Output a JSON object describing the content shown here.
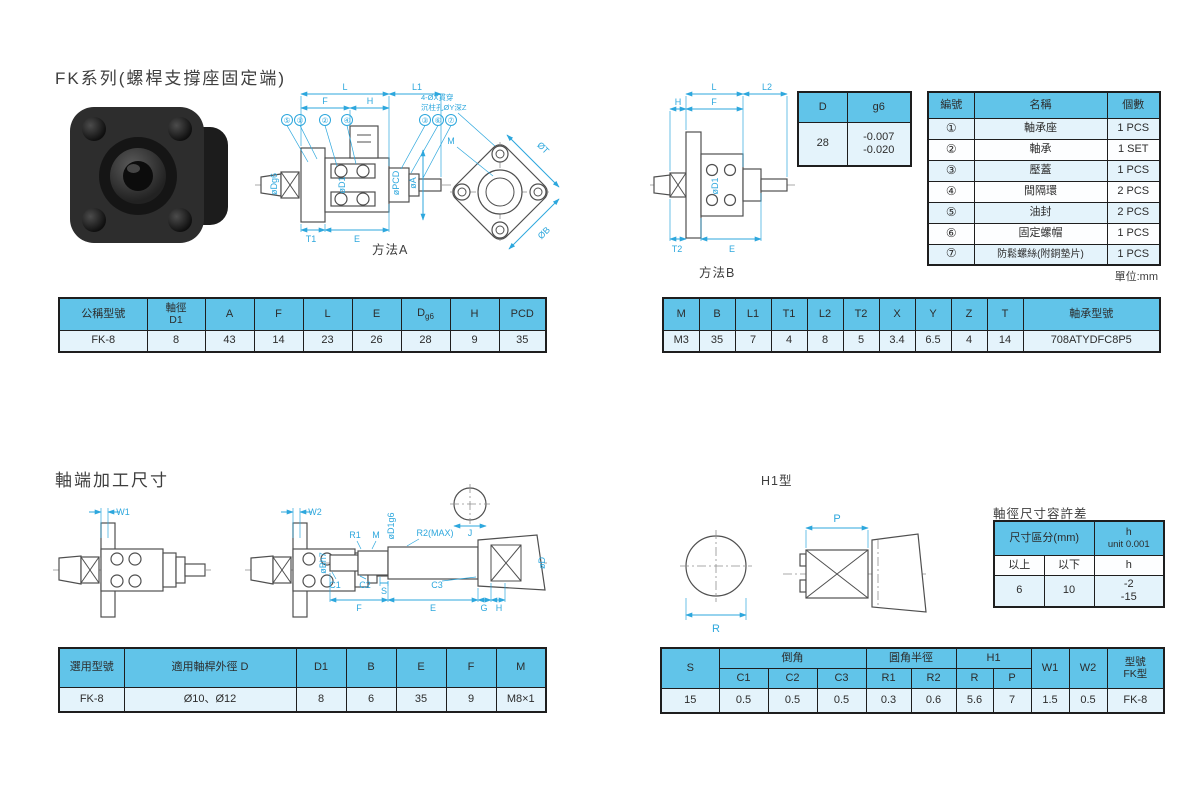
{
  "titles": {
    "main": "FK系列(螺桿支撐座固定端)",
    "shaft_end": "軸端加工尺寸",
    "unit": "單位:mm"
  },
  "fit_table": {
    "col1": "D",
    "col2": "g6",
    "d": "28",
    "g6_line1": "-0.007",
    "g6_line2": "-0.020"
  },
  "parts_table": {
    "h_no": "編號",
    "h_name": "名稱",
    "h_qty": "個數",
    "rows": [
      {
        "no": "①",
        "name": "軸承座",
        "qty": "1 PCS"
      },
      {
        "no": "②",
        "name": "軸承",
        "qty": "1 SET"
      },
      {
        "no": "③",
        "name": "壓蓋",
        "qty": "1 PCS"
      },
      {
        "no": "④",
        "name": "間隔環",
        "qty": "2 PCS"
      },
      {
        "no": "⑤",
        "name": "油封",
        "qty": "2 PCS"
      },
      {
        "no": "⑥",
        "name": "固定螺帽",
        "qty": "1 PCS"
      },
      {
        "no": "⑦",
        "name": "防鬆螺絲(附銅墊片)",
        "qty": "1 PCS"
      }
    ]
  },
  "dim_table_A": {
    "h_model": "公稱型號",
    "h_shaft_a": "軸徑",
    "h_shaft_b": "D1",
    "h_a": "A",
    "h_f": "F",
    "h_l": "L",
    "h_e": "E",
    "h_d": "D",
    "h_d_sub": "g6",
    "h_h": "H",
    "h_pcd": "PCD",
    "row": [
      "FK-8",
      "8",
      "43",
      "14",
      "23",
      "26",
      "28",
      "9",
      "35"
    ]
  },
  "dim_table_B": {
    "headers": [
      "M",
      "B",
      "L1",
      "T1",
      "L2",
      "T2",
      "X",
      "Y",
      "Z",
      "T",
      "軸承型號"
    ],
    "row": [
      "M3",
      "35",
      "7",
      "4",
      "8",
      "5",
      "3.4",
      "6.5",
      "4",
      "14",
      "708ATYDFC8P5"
    ]
  },
  "tolerance_table": {
    "title": "軸徑尺寸容許差",
    "h_range": "尺寸區分(mm)",
    "h_unit_a": "h",
    "h_unit_b": "unit 0.001",
    "sub": [
      "以上",
      "以下",
      "h"
    ],
    "row": [
      "6",
      "10"
    ],
    "tol_a": "-2",
    "tol_b": "-15"
  },
  "shaft_table": {
    "headers": [
      "選用型號",
      "適用軸桿外徑 D",
      "D1",
      "B",
      "E",
      "F",
      "M"
    ],
    "row": [
      "FK-8",
      "Ø10、Ø12",
      "8",
      "6",
      "35",
      "9",
      "M8×1"
    ]
  },
  "corner_table": {
    "h_s": "S",
    "g_chamfer": "倒角",
    "g_radius": "圓角半徑",
    "g_h1": "H1",
    "sub": [
      "C1",
      "C2",
      "C3",
      "R1",
      "R2",
      "R",
      "P"
    ],
    "h_w1": "W1",
    "h_w2": "W2",
    "h_model_a": "型號",
    "h_model_b": "FK型",
    "row": [
      "15",
      "0.5",
      "0.5",
      "0.5",
      "0.3",
      "0.6",
      "5.6",
      "7",
      "1.5",
      "0.5",
      "FK-8"
    ]
  },
  "drawingA": {
    "caption": "方法A",
    "note1": "4-ØX貫穿",
    "note2": "沉柱孔ØY深Z",
    "callouts": [
      "⑤",
      "①",
      "②",
      "④",
      "③",
      "⑥",
      "⑦"
    ],
    "dims": {
      "L": "L",
      "L1": "L1",
      "F": "F",
      "H": "H",
      "T1": "T1",
      "E": "E",
      "M": "M",
      "dT": "ØT",
      "dB": "ØB",
      "dDg6": "øDg6",
      "dD1": "øD1",
      "dPCD": "øPCD",
      "dA": "øA"
    }
  },
  "drawingB": {
    "caption": "方法B",
    "dims": {
      "L": "L",
      "L2": "L2",
      "H": "H",
      "F": "F",
      "dD1": "øD1",
      "T2": "T2",
      "E": "E"
    }
  },
  "drawingShaft": {
    "dims": {
      "W1": "W1",
      "W2": "W2",
      "R1": "R1",
      "M": "M",
      "dD1g6": "øD1g6",
      "R2": "R2(MAX)",
      "J": "J",
      "dB": "øBh7",
      "C1": "C1",
      "C2": "C2",
      "S": "S",
      "C3": "C3",
      "F": "F",
      "E": "E",
      "G": "G",
      "H": "H",
      "dD": "øD"
    }
  },
  "drawingH1": {
    "caption": "H1型",
    "dims": {
      "P": "P",
      "R": "R"
    }
  }
}
